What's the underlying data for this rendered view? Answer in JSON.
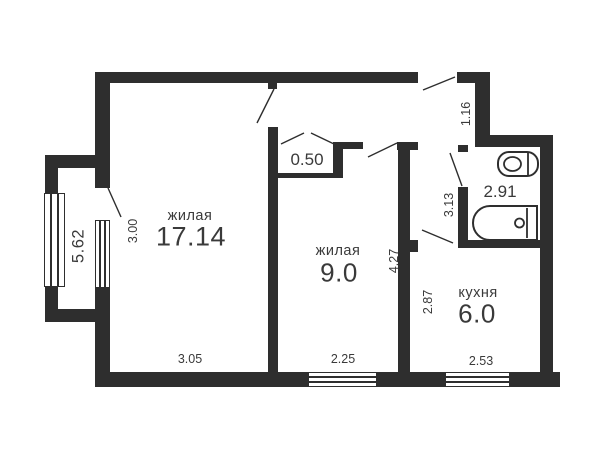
{
  "plan": {
    "type": "apartment-floor-plan",
    "language": "ru",
    "colors": {
      "wall": "#2e2e2e",
      "text": "#3a3a3a",
      "background": "#ffffff"
    },
    "rooms": [
      {
        "id": "living-1",
        "name": "жилая",
        "area": "17.14"
      },
      {
        "id": "living-2",
        "name": "жилая",
        "area": "9.0"
      },
      {
        "id": "kitchen",
        "name": "кухня",
        "area": "6.0"
      },
      {
        "id": "bathroom",
        "name": "",
        "area": "2.91"
      },
      {
        "id": "closet",
        "name": "",
        "area": "0.50"
      },
      {
        "id": "balcony",
        "name": "",
        "area": ""
      }
    ],
    "dimensions": [
      {
        "id": "balcony-length",
        "value": "5.62"
      },
      {
        "id": "living1-width",
        "value": "3.00"
      },
      {
        "id": "living1-length",
        "value": "3.05"
      },
      {
        "id": "living2-width",
        "value": "2.25"
      },
      {
        "id": "living2-length",
        "value": "4.27"
      },
      {
        "id": "kitchen-width",
        "value": "2.53"
      },
      {
        "id": "kitchen-length",
        "value": "2.87"
      },
      {
        "id": "hall-length",
        "value": "3.13"
      },
      {
        "id": "entry-width",
        "value": "1.16"
      }
    ],
    "fixtures": [
      "toilet",
      "bathtub"
    ],
    "openings": [
      "entrance-door",
      "living1-door",
      "living2-door",
      "closet-folding-doors",
      "bathroom-door",
      "kitchen-door",
      "balcony-door"
    ]
  }
}
